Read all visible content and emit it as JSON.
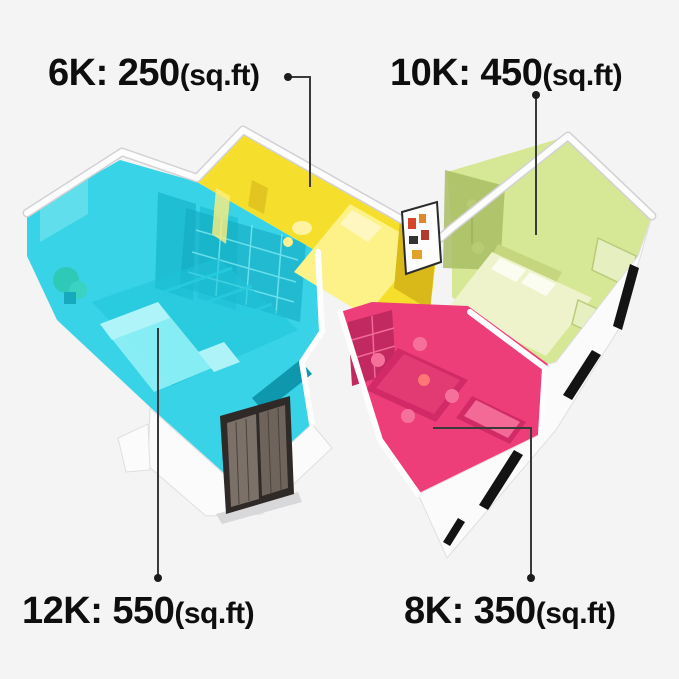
{
  "background": "#f4f4f5",
  "text_color": "#0e0e0e",
  "leader_color": "#3a3a3a",
  "labels": {
    "six_k": {
      "text": "6K: 250",
      "size": "6K",
      "area": "250",
      "unit": "(sq.ft)"
    },
    "ten_k": {
      "text": "10K: 450",
      "size": "10K",
      "area": "450",
      "unit": "(sq.ft)"
    },
    "twelve_k": {
      "text": "12K: 550",
      "size": "12K",
      "area": "550",
      "unit": "(sq.ft)"
    },
    "eight_k": {
      "text": "8K: 350",
      "size": "8K",
      "area": "350",
      "unit": "(sq.ft)"
    }
  },
  "rooms": {
    "living_cyan": {
      "color": "#38d3e6",
      "label_ref": "12K: 550(sq.ft)"
    },
    "bedroom_yellow": {
      "color": "#f6df2c",
      "label_ref": "6K: 250(sq.ft)"
    },
    "bedroom_green": {
      "color": "#d6e795",
      "label_ref": "10K: 450(sq.ft)"
    },
    "dining_pink": {
      "color": "#ee3e79",
      "label_ref": "8K: 350(sq.ft)"
    }
  },
  "door_color": "#7b7168",
  "icons": {
    "leader_dot": "round connector dot"
  }
}
